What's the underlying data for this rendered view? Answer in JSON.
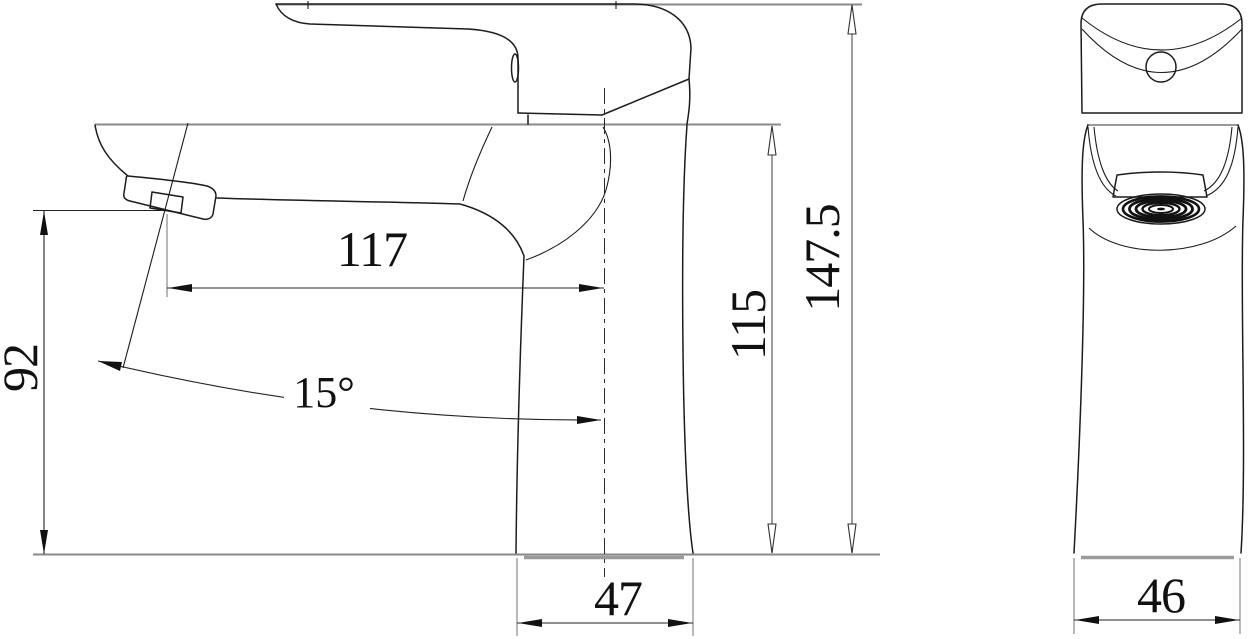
{
  "drawing": {
    "type": "technical-drawing",
    "subject": "single-lever basin faucet, side and front orthographic views",
    "dimensions": {
      "spout_reach": "117",
      "outlet_height": "92",
      "body_height": "115",
      "overall_height": "147.5",
      "base_depth": "47",
      "base_width": "46",
      "spray_angle": "15°"
    },
    "colors": {
      "background": "#ffffff",
      "outline": "#1c1c1c",
      "reference_line": "#8a8a8a",
      "dimension_line": "#222222"
    }
  }
}
